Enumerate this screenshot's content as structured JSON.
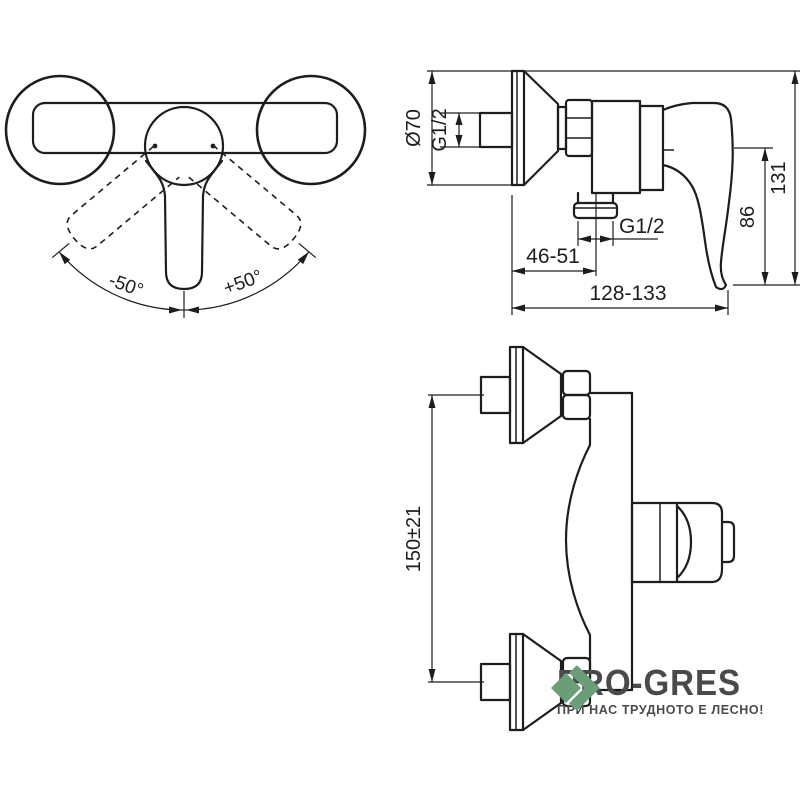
{
  "colors": {
    "background": "#ffffff",
    "line": "#1d1d1b",
    "logo_text": "#4a4a4c",
    "logo_accent": "#699e77"
  },
  "front_view": {
    "label_angle_left": "-50°",
    "label_angle_right": "+50°"
  },
  "side_view": {
    "label_diameter": "Ø70",
    "label_inlet_thread": "G1/2",
    "label_total_height": "131",
    "label_outlet_height": "86",
    "label_outlet_thread": "G1/2",
    "label_wall_to_outlet": "46-51",
    "label_total_depth": "128-133"
  },
  "top_view": {
    "label_centers_distance": "150±21"
  },
  "logo": {
    "brand": "PRO-GRES",
    "tagline": "ПРИ НАС ТРУДНОТО Е ЛЕСНО!"
  }
}
